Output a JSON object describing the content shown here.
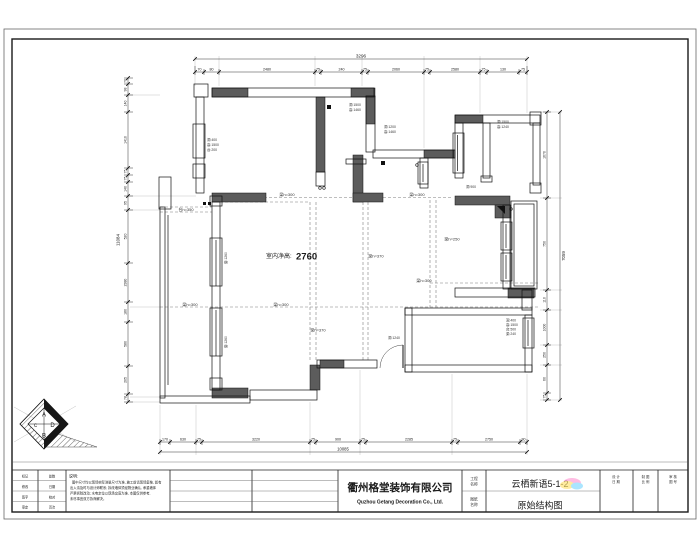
{
  "page": {
    "background": "#ffffff",
    "line_color": "#111111",
    "wall_fill": "#5c5c5c",
    "dash_color": "#7f7f7f",
    "highlight_colors": [
      "#ff9ad5",
      "#ffe36e",
      "#7fd8ff"
    ]
  },
  "plan": {
    "ceiling_label": "室内净高:",
    "ceiling_value": "2760",
    "beams": {
      "b300": "梁h=300",
      "b370": "梁h=370",
      "b250": "梁h=250",
      "sill": "台h=350"
    },
    "window_labels": {
      "w1a": "洞:1500",
      "w1b": "高:1460",
      "w2a": "洞:1200",
      "w2b": "高:1460",
      "w3a": "洞:1500",
      "w3b": "高:1240",
      "w4a": "洞:400",
      "w4b": "高:1500",
      "w4c": "台:200",
      "w5a": "洞:400",
      "w5b": "高:1500",
      "w5c": "台:500",
      "w5d": "梁:240",
      "w6": "洞:900",
      "side1": "窗:1260",
      "side2": "窗:1260",
      "side3": "洞:1240"
    }
  },
  "dimensions": {
    "top": {
      "overall": "3296",
      "segments": [
        "70",
        "80",
        "2480",
        "75",
        "240",
        "75",
        "2060",
        "75",
        "2580",
        "75",
        "130",
        "75"
      ]
    },
    "left": {
      "overall": "11084",
      "segments": [
        "70",
        "98",
        "140",
        "1410",
        "75",
        "75",
        "140",
        "95",
        "520",
        "2380",
        "180",
        "580",
        "205",
        "78"
      ]
    },
    "right": {
      "overall": "7059",
      "segments": [
        "1670",
        "750",
        "110",
        "1000",
        "250",
        "60",
        "75"
      ]
    },
    "bottom": {
      "overall": "10085",
      "segments": [
        "170",
        "630",
        "75",
        "3220",
        "75",
        "900",
        "75",
        "2285",
        "75",
        "2750",
        "80"
      ]
    }
  },
  "logo": {
    "top": "A",
    "right": "D",
    "bottom": "B",
    "left": "c"
  },
  "title_block": {
    "company_cn": "衢州格堂装饰有限公司",
    "company_en": "Quzhou Getang Decoration Co., Ltd.",
    "project_label_1": "工程",
    "project_label_2": "名称",
    "drawing_label_1": "图纸",
    "drawing_label_2": "名称",
    "project_name": "云栖新语5-1-2",
    "drawing_name": "原始结构图",
    "col1_l1": "设 计",
    "col1_l2": "日 期",
    "col2_l1": "制 图",
    "col2_l2": "比 例",
    "col3_l1": "审 核",
    "col3_l2": "图 号",
    "notes_title": "说明:",
    "notes_line1": "图中尺寸均以现场实际测量尺寸为准, 施工前请现场复核, 如有",
    "notes_line2": "出入请及时与设计师联系; 拆改墙体须经物业确认, 承重墙体",
    "notes_line3": "严禁拆除改动; 水电定位以现场交底为准, 本图仅供参考,",
    "notes_line4": "未尽事宜双方协商解决。",
    "rev_rows": [
      [
        "标记",
        "处数"
      ],
      [
        "修改",
        "日期"
      ],
      [
        "签字",
        "校对"
      ],
      [
        "审定",
        "页次"
      ]
    ]
  }
}
